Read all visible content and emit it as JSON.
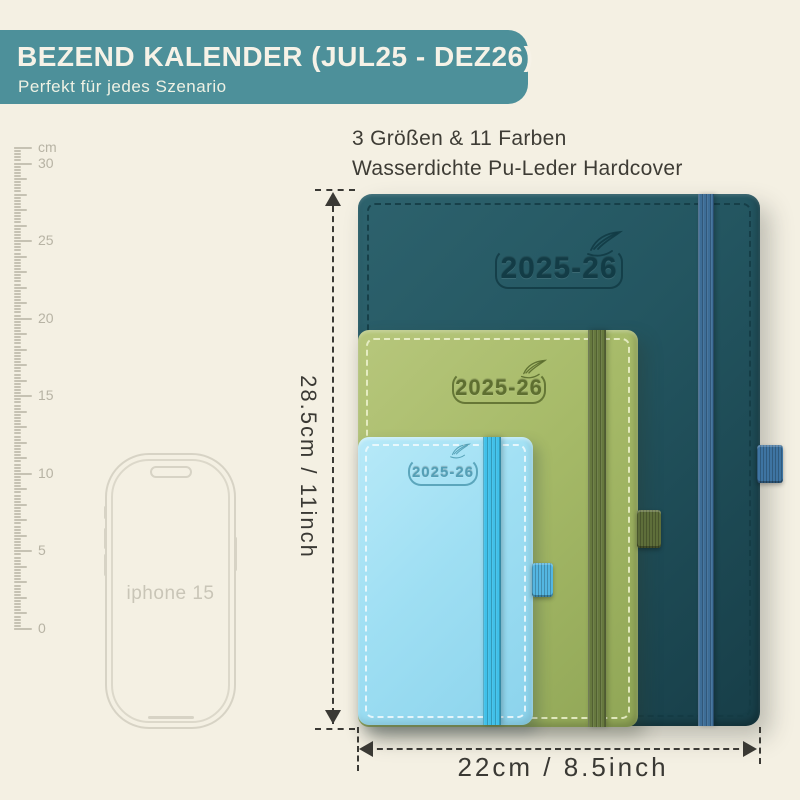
{
  "header": {
    "title": "BEZEND KALENDER (JUL25 - DEZ26)",
    "subtitle": "Perfekt für jedes Szenario",
    "bg": "#4d909a",
    "text_color": "#f6f2e7"
  },
  "intro": {
    "line1": "3 Größen & 11 Farben",
    "line2": "Wasserdichte Pu-Leder Hardcover"
  },
  "ruler": {
    "labels": [
      {
        "text": "cm",
        "y": 147
      },
      {
        "text": "30",
        "y": 163
      },
      {
        "text": "25",
        "y": 240
      },
      {
        "text": "20",
        "y": 318
      },
      {
        "text": "15",
        "y": 395
      },
      {
        "text": "10",
        "y": 473
      },
      {
        "text": "5",
        "y": 550
      },
      {
        "text": "0",
        "y": 628
      }
    ]
  },
  "phone": {
    "label": "iphone 15"
  },
  "notebooks": [
    {
      "name": "large",
      "label": "2025-26",
      "cover": "#235560",
      "cover_light": "#2d626d",
      "cover_dark": "#173e48",
      "stitch": "#143b44",
      "band": "#3d6d97",
      "loop": "#3e74a2",
      "logo": "#123b45"
    },
    {
      "name": "medium",
      "label": "2025-26",
      "cover": "#a6ba68",
      "cover_light": "#b7c77c",
      "cover_dark": "#90a656",
      "stitch": "#eef3cf",
      "band": "#66783e",
      "loop": "#5e6e3a",
      "logo": "#5a6b2d"
    },
    {
      "name": "small",
      "label": "2025-26",
      "cover": "#9fdff3",
      "cover_light": "#b7e9f8",
      "cover_dark": "#8bd3ec",
      "stitch": "#f2fbfe",
      "band": "#3fc0e9",
      "loop": "#54b6e2",
      "logo": "#4f9cb3"
    }
  ],
  "dimensions": {
    "height_label": "28.5cm / 11inch",
    "width_label": "22cm / 8.5inch",
    "line_color": "#3a3934"
  }
}
